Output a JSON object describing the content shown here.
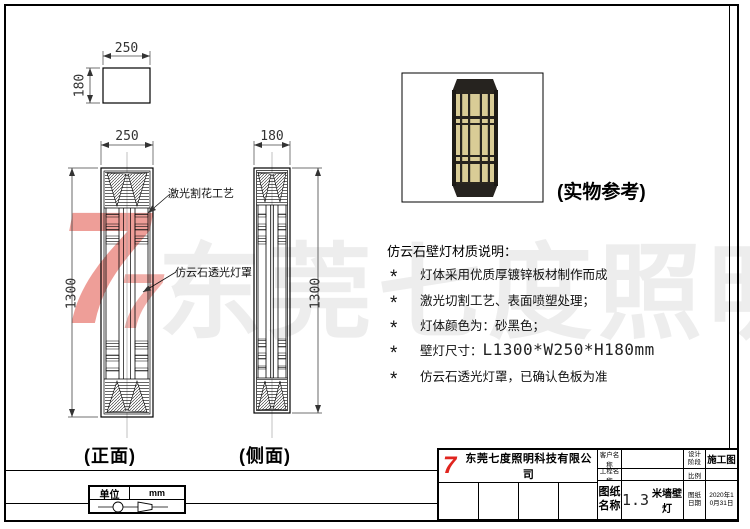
{
  "watermark": {
    "text": "东莞七度照明",
    "logo_glyph": "7",
    "text_color": "#ededed",
    "logo_color": "#e03c32"
  },
  "plan_view": {
    "dim_width": "250",
    "dim_height": "180"
  },
  "front_view": {
    "name": "(正面)",
    "dim_width": "250",
    "dim_height": "1300",
    "callout_top": "激光割花工艺",
    "callout_bottom": "仿云石透光灯罩"
  },
  "side_view": {
    "name": "(侧面)",
    "dim_width": "180",
    "dim_height": "1300"
  },
  "photo": {
    "caption": "(实物参考)",
    "frame_color": "#26231f",
    "panel_color": "#d9cc96"
  },
  "notes": {
    "title": "仿云石壁灯材质说明：",
    "bullet": "*",
    "items": [
      {
        "text": "灯体采用优质厚镀锌板材制作而成"
      },
      {
        "text": "激光切割工艺、表面喷塑处理；"
      },
      {
        "text": "灯体颜色为：砂黑色；"
      },
      {
        "text": "壁灯尺寸：",
        "dim": "L1300*W250*H180mm"
      },
      {
        "text": "仿云石透光灯罩，已确认色板为准"
      }
    ]
  },
  "unit_table": {
    "label": "单位",
    "value": "mm"
  },
  "title_block": {
    "company": "东莞七度照明科技有限公司",
    "logo_glyph": "7",
    "customer_label": "客户名称",
    "customer_value": "",
    "stage_label": "设计阶段",
    "stage_value": "施工图",
    "project_label": "工程名称",
    "project_value": "",
    "scale_label": "比例",
    "scale_value": "",
    "drawing_label": "图纸名称",
    "drawing_number": "1.3",
    "drawing_name": "米墙壁灯",
    "date_label": "图纸日期",
    "date_value": "2020年10月31日"
  }
}
